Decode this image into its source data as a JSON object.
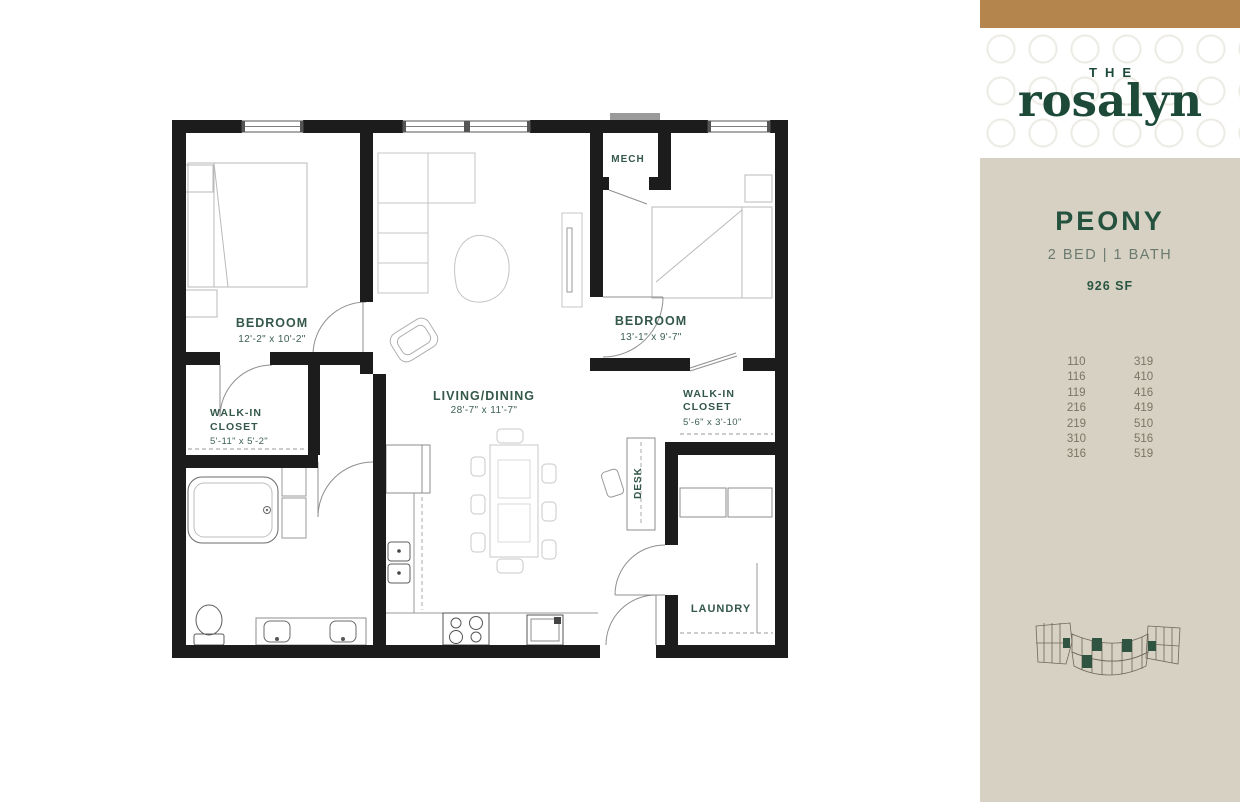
{
  "branding": {
    "logo_top": "THE",
    "logo_name": "rosalyn",
    "accent_bar_color": "#b5854e",
    "brand_green": "#1d4a38",
    "sidebar_background": "#d6d1c2"
  },
  "unit": {
    "name": "PEONY",
    "specs": "2 BED | 1 BATH",
    "area": "926 SF",
    "available_units": {
      "column_1": [
        "110",
        "116",
        "119",
        "216",
        "219",
        "310",
        "316"
      ],
      "column_2": [
        "319",
        "410",
        "416",
        "419",
        "510",
        "516",
        "519"
      ]
    }
  },
  "floor_plan": {
    "label_color": "#345849",
    "labels": {
      "bedroom_1": {
        "name": "BEDROOM",
        "dims": "12'-2\" x 10'-2\""
      },
      "living_dining": {
        "name": "LIVING/DINING",
        "dims": "28'-7\" x 11'-7\""
      },
      "bedroom_2": {
        "name": "BEDROOM",
        "dims": "13'-1\" x 9'-7\""
      },
      "closet_1": {
        "line1": "WALK-IN",
        "line2": "CLOSET",
        "dims": "5'-11\" x 5'-2\""
      },
      "closet_2": {
        "line1": "WALK-IN",
        "line2": "CLOSET",
        "dims": "5'-6\" x 3'-10\""
      },
      "mech": "MECH",
      "desk": "DESK",
      "laundry": "LAUNDRY"
    }
  }
}
